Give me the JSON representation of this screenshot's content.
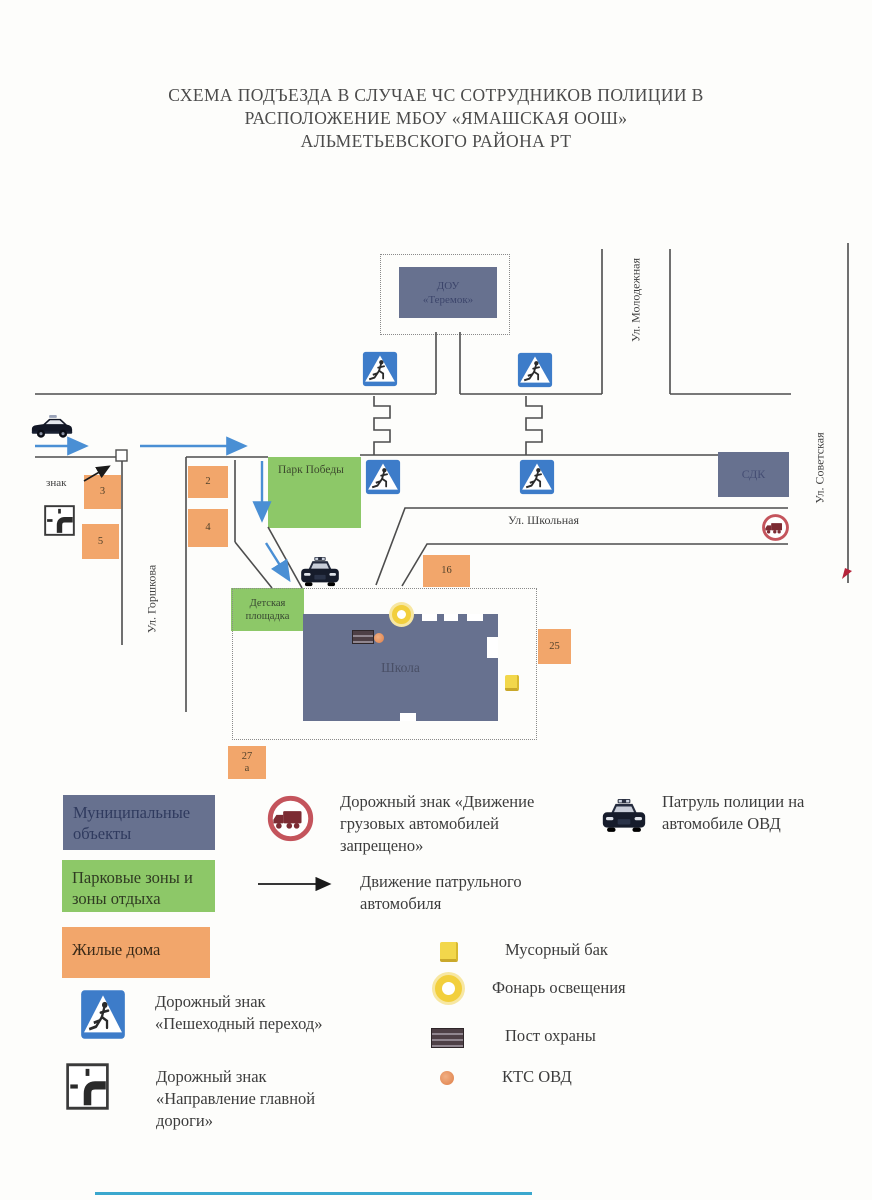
{
  "title": {
    "line1": "СХЕМА ПОДЪЕЗДА В СЛУЧАЕ ЧС СОТРУДНИКОВ ПОЛИЦИИ В",
    "line2": "РАСПОЛОЖЕНИЕ МБОУ «ЯМАШСКАЯ ООШ»",
    "line3": "АЛЬМЕТЬЕВСКОГО РАЙОНА РТ"
  },
  "map": {
    "streets": {
      "molodezhnaya": "Ул. Молодежная",
      "sovetskaya": "Ул. Советская",
      "gorshkova": "Ул. Горшкова",
      "shkolnaya": "Ул. Школьная"
    },
    "objects": {
      "dou": "ДОУ\n«Теремок»",
      "sdk": "СДК",
      "school": "Школа",
      "park": "Парк Победы",
      "playground": "Детская\nплощадка"
    },
    "houses": [
      "3",
      "5",
      "2",
      "4",
      "16",
      "25",
      "27\nа"
    ],
    "znak_label": "знак"
  },
  "legend": {
    "municipal": "Муниципальные\nобъекты",
    "park_zones": "Парковые зоны и\nзоны отдыха",
    "residential": "Жилые дома",
    "no_trucks": "Дорожный знак «Движение\nгрузовых автомобилей\nзапрещено»",
    "patrol_movement": "Движение патрульного\nавтомобиля",
    "police_patrol": "Патруль полиции на\nавтомобиле ОВД",
    "trash": "Мусорный бак",
    "lantern": "Фонарь освещения",
    "guard_post": "Пост охраны",
    "kts": "КТС ОВД",
    "ped_crossing": "Дорожный знак\n«Пешеходный переход»",
    "main_road": "Дорожный знак\n«Направление главной\nдороги»"
  },
  "colors": {
    "municipal": "#67718f",
    "park": "#8dc868",
    "residential": "#f2a66b",
    "sign_blue": "#3d7cc9",
    "arrow_blue": "#4a8fd4",
    "prohibit_red": "#c4545c",
    "yellow": "#f2cf3d",
    "kts_orange": "#e8935f"
  }
}
